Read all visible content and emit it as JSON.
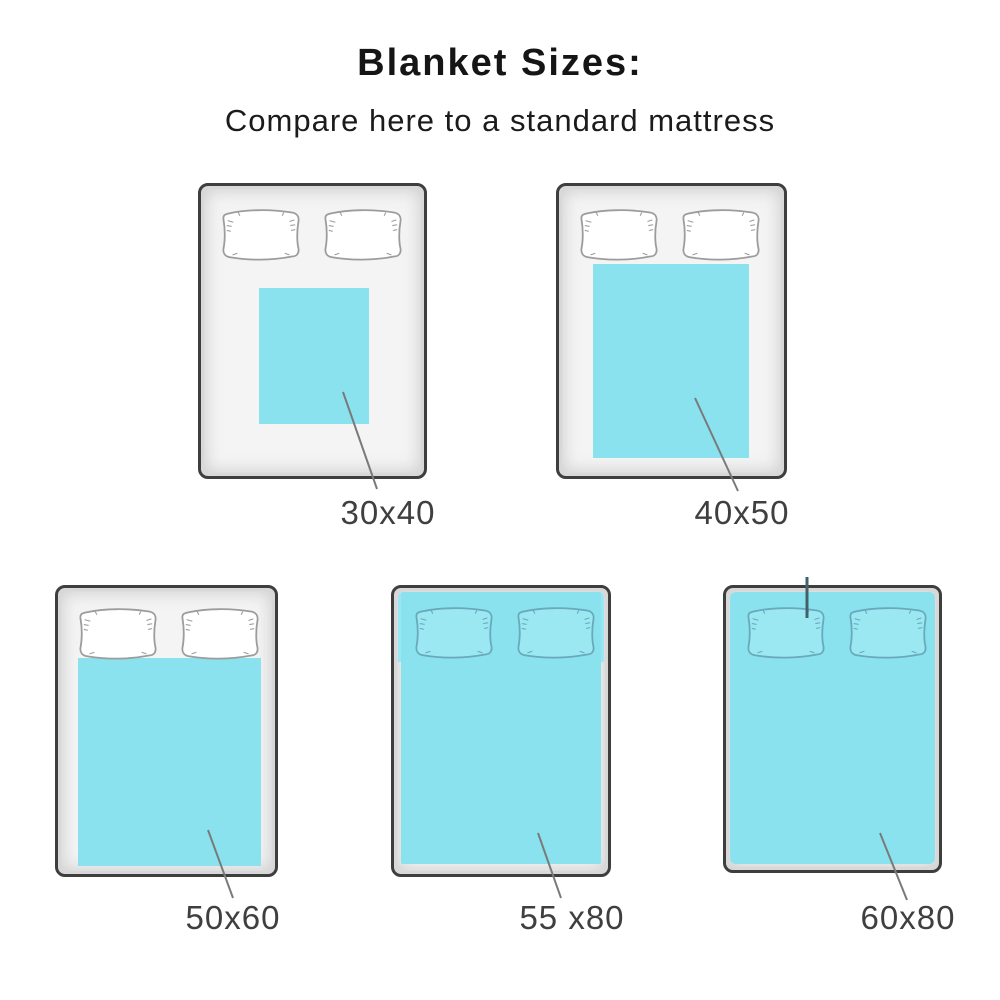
{
  "header": {
    "title": "Blanket Sizes:",
    "subtitle": "Compare here to a standard mattress"
  },
  "beds": [
    {
      "label": "30x40"
    },
    {
      "label": "40x50"
    },
    {
      "label": "50x60"
    },
    {
      "label": "55 x80"
    },
    {
      "label": "60x80"
    }
  ],
  "colors": {
    "blanket": "#8AE2EF",
    "bed_frame": "#3E3E3E",
    "mattress": "#F4F4F4",
    "pillow_outline_white_bed": "#9C9C9C",
    "pillow_outline_cyan_bed": "#68A9BB",
    "leader_line": "#7A7A7A",
    "label_text": "#3F3F3F"
  }
}
